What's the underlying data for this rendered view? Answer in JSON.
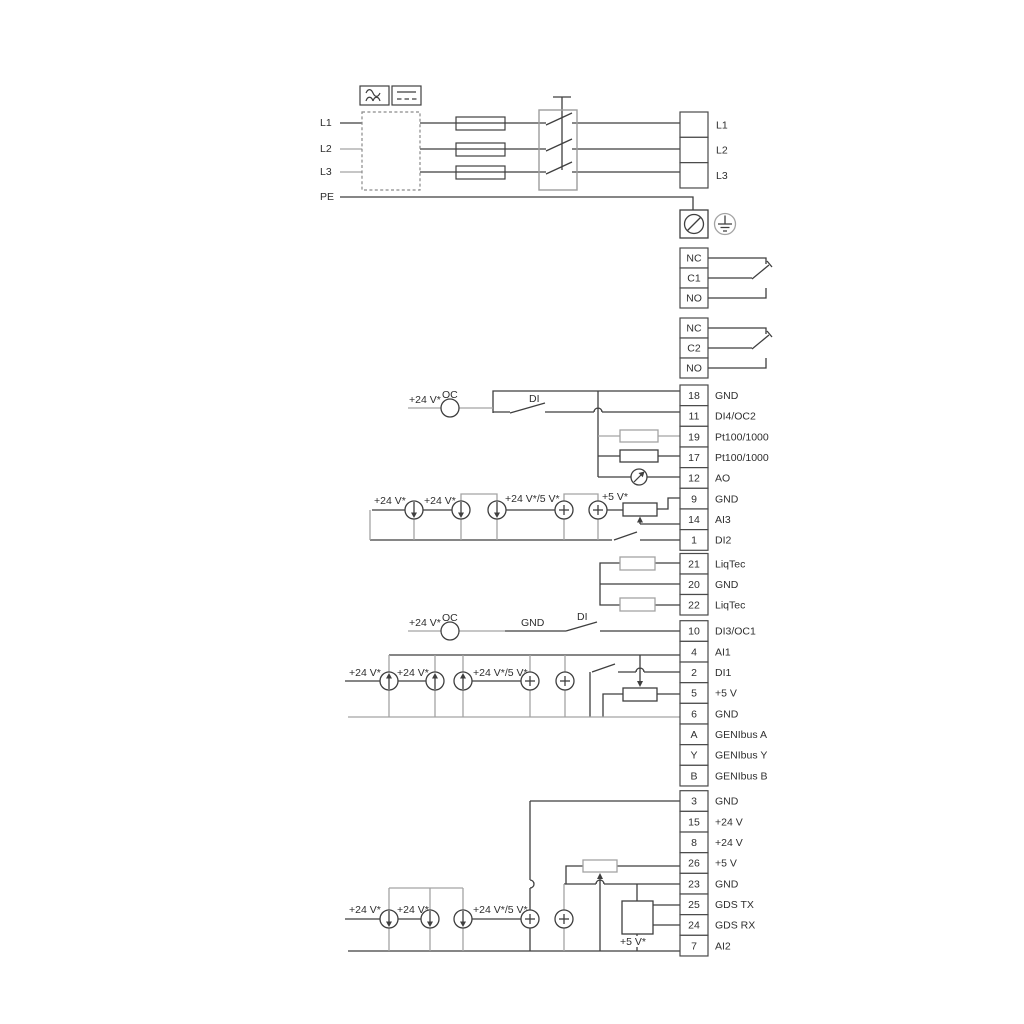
{
  "power": {
    "left_labels": [
      "L1",
      "L2",
      "L3",
      "PE"
    ],
    "right": [
      {
        "n": "",
        "label": "L1"
      },
      {
        "n": "",
        "label": "L2"
      },
      {
        "n": "",
        "label": "L3"
      }
    ]
  },
  "relay1": [
    {
      "n": "NC",
      "label": ""
    },
    {
      "n": "C1",
      "label": ""
    },
    {
      "n": "NO",
      "label": ""
    }
  ],
  "relay2": [
    {
      "n": "NC",
      "label": ""
    },
    {
      "n": "C2",
      "label": ""
    },
    {
      "n": "NO",
      "label": ""
    }
  ],
  "io1": [
    {
      "n": "18",
      "label": "GND"
    },
    {
      "n": "11",
      "label": "DI4/OC2"
    },
    {
      "n": "19",
      "label": "Pt100/1000"
    },
    {
      "n": "17",
      "label": "Pt100/1000"
    },
    {
      "n": "12",
      "label": "AO"
    },
    {
      "n": "9",
      "label": "GND"
    },
    {
      "n": "14",
      "label": "AI3"
    },
    {
      "n": "1",
      "label": "DI2"
    }
  ],
  "liqtec": [
    {
      "n": "21",
      "label": "LiqTec"
    },
    {
      "n": "20",
      "label": "GND"
    },
    {
      "n": "22",
      "label": "LiqTec"
    }
  ],
  "io2": [
    {
      "n": "10",
      "label": "DI3/OC1"
    },
    {
      "n": "4",
      "label": "AI1"
    },
    {
      "n": "2",
      "label": "DI1"
    },
    {
      "n": "5",
      "label": "+5 V"
    },
    {
      "n": "6",
      "label": "GND"
    },
    {
      "n": "A",
      "label": "GENIbus A"
    },
    {
      "n": "Y",
      "label": "GENIbus Y"
    },
    {
      "n": "B",
      "label": "GENIbus B"
    }
  ],
  "io3": [
    {
      "n": "3",
      "label": "GND"
    },
    {
      "n": "15",
      "label": "+24 V"
    },
    {
      "n": "8",
      "label": "+24 V"
    },
    {
      "n": "26",
      "label": "+5 V"
    },
    {
      "n": "23",
      "label": "GND"
    },
    {
      "n": "25",
      "label": "GDS TX"
    },
    {
      "n": "24",
      "label": "GDS RX"
    },
    {
      "n": "7",
      "label": "AI2"
    }
  ],
  "ann": {
    "v24": "+24 V*",
    "v24_5": "+24 V*/5 V*",
    "v5": "+5 V*",
    "oc": "OC",
    "di": "DI",
    "gnd": "GND"
  },
  "colors": {
    "line_dark": "#3f3f3f",
    "line_gray": "#a3a3a3",
    "text": "#2e2e2e"
  }
}
